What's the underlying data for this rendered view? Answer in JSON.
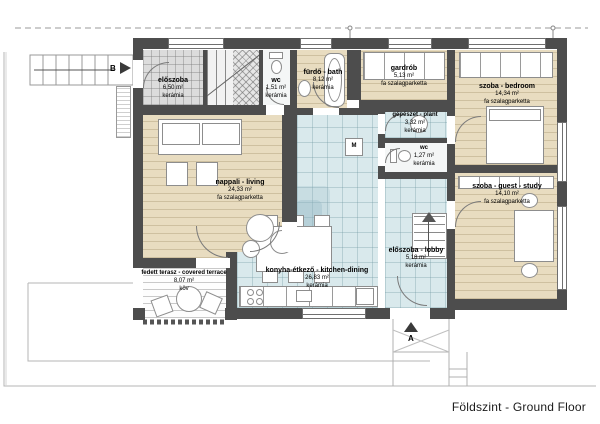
{
  "title": "Földszint - Ground Floor",
  "markers": {
    "section_b": "B",
    "section_a": "A",
    "washing_machine": "M"
  },
  "colors": {
    "wall": "#4d4d4d",
    "wood_floor": "#e8dcc0",
    "ceramic_floor": "#d9e9ec",
    "gray_tile_floor": "#dcdcdc"
  },
  "rooms": [
    {
      "name": "előszoba",
      "area": "6,50 m²",
      "floor": "kerámia"
    },
    {
      "name": "wc",
      "area": "1,51 m²",
      "floor": "kerámia"
    },
    {
      "name": "fürdő - bath",
      "area": "8,12 m²",
      "floor": "kerámia"
    },
    {
      "name": "gardrób",
      "area": "5,13 m²",
      "floor": "fa szalagparketta"
    },
    {
      "name": "szoba - bedroom",
      "area": "14,34 m²",
      "floor": "fa szalagparketta"
    },
    {
      "name": "gépészet - plant",
      "area": "3,32 m²",
      "floor": "kerámia"
    },
    {
      "name": "wc",
      "area": "1,27 m²",
      "floor": "kerámia"
    },
    {
      "name": "nappali - living",
      "area": "24,33 m²",
      "floor": "fa szalagparketta"
    },
    {
      "name": "szoba - guest - study",
      "area": "14,10 m²",
      "floor": "fa szalagparketta"
    },
    {
      "name": "előszoba - lobby",
      "area": "5,18 m²",
      "floor": "kerámia"
    },
    {
      "name": "konyha-étkező - kitchen-dining",
      "area": "26,83 m²",
      "floor": "kerámia"
    },
    {
      "name": "fedett terasz - covered terrace",
      "area": "8,07 m²",
      "floor": "köv"
    }
  ]
}
